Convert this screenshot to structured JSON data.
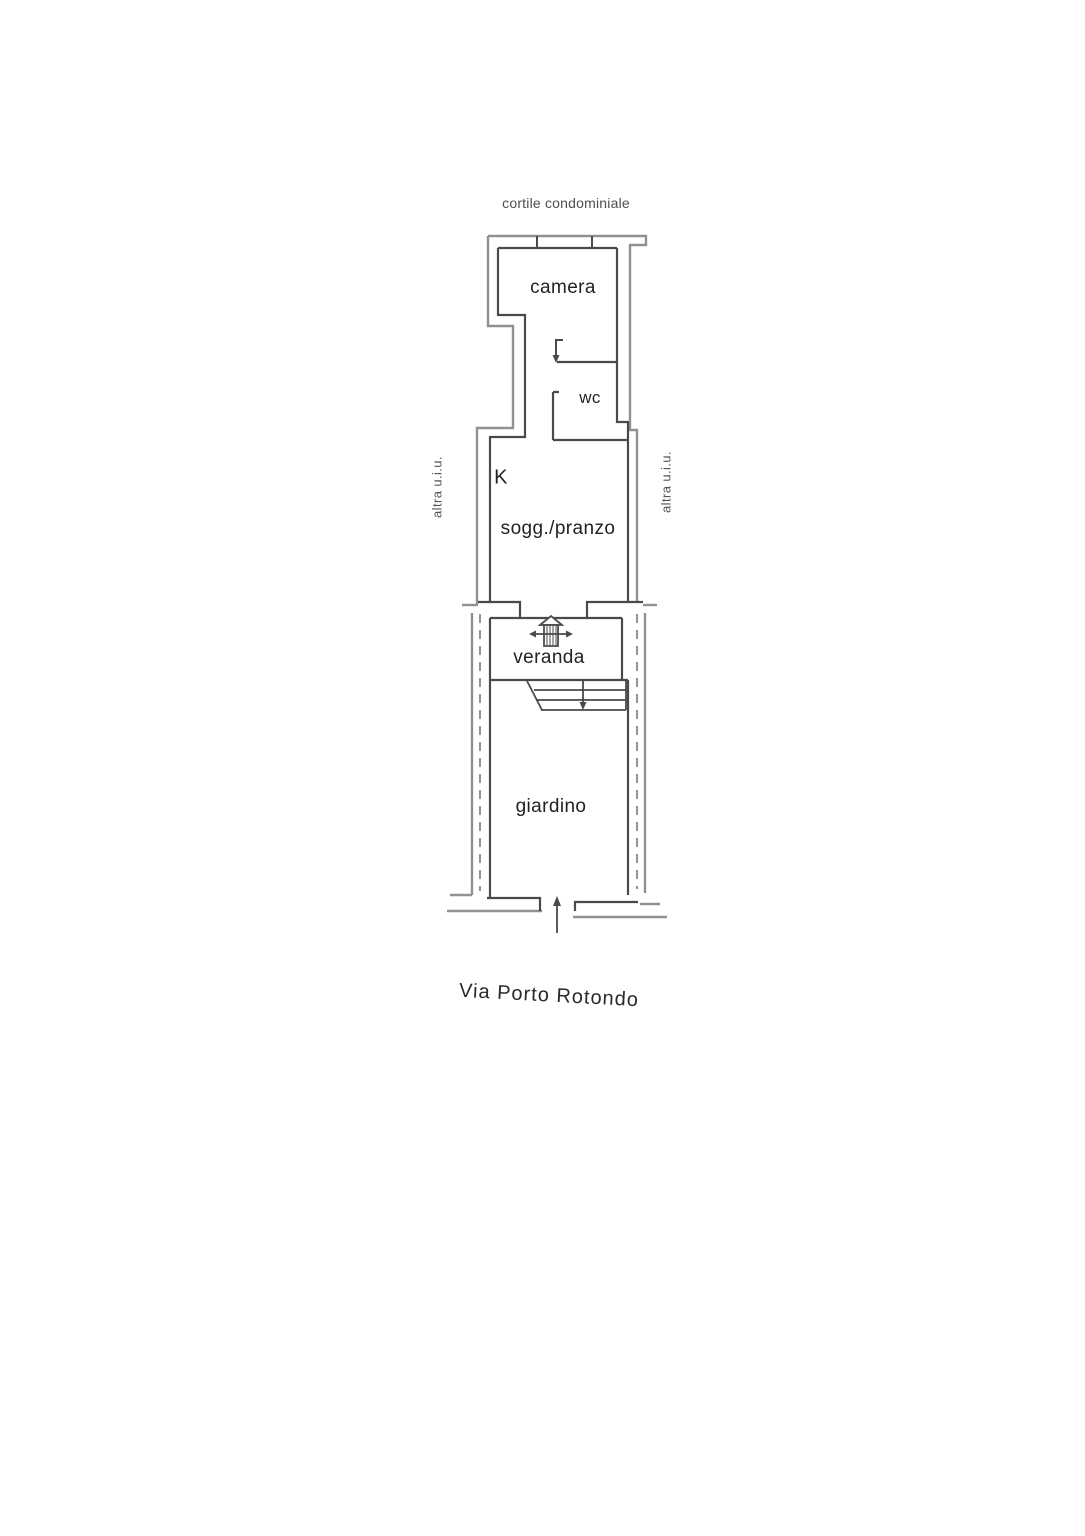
{
  "plan": {
    "background": "#ffffff",
    "line_colors": {
      "wall": "#4a4a4a",
      "site_boundary": "#919191",
      "dashed_projection": "#7a7a7a"
    },
    "text_color": "#222222",
    "labels": {
      "courtyard": "cortile condominiale",
      "bedroom": "camera",
      "wc": "wc",
      "kitchen": "K",
      "living_dining": "sogg./pranzo",
      "other_unit_left": "altra u.i.u.",
      "other_unit_right": "altra u.i.u.",
      "veranda": "veranda",
      "garden": "giardino",
      "street": "Via Porto Rotondo"
    },
    "icons": {
      "window": "window-symbol",
      "entry_door": "entry-door-symbol",
      "wc_door": "wc-door-swing-icon",
      "stairs": "stairs-symbol",
      "stairs_direction": "stairs-down-arrow-icon",
      "street_entrance": "street-entrance-arrow-icon"
    }
  }
}
